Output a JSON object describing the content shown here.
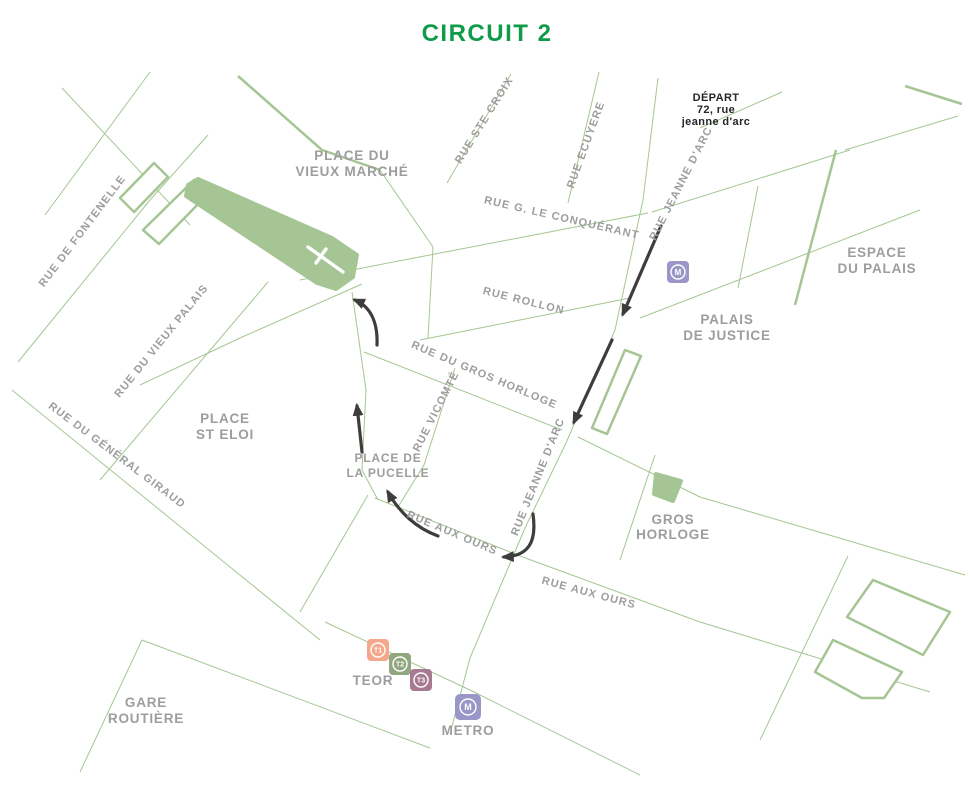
{
  "title": "CIRCUIT 2",
  "colors": {
    "bg": "#ffffff",
    "street-line": "#a5c694",
    "area-fill": "#a5c694",
    "label": "#9d9d9d",
    "title-green": "#109b4a",
    "depart": "#262626",
    "route": "#3d3d3d"
  },
  "streets": {
    "ste_croix": "RUE STE CROIX",
    "ecuyere": "RUE ECUYERE",
    "jeanne_arc_top": "RUE JEANNE D'ARC",
    "jeanne_arc_low": "RUE JEANNE D'ARC",
    "conquerant": "RUE G. LE CONQUÉRANT",
    "rollon": "RUE ROLLON",
    "gros_horloge": "RUE DU GROS HORLOGE",
    "vicomte": "RUE VICOMTÉ",
    "aux_ours_w": "RUE AUX OURS",
    "aux_ours_e": "RUE AUX OURS",
    "fontenelle": "RUE DE FONTENELLE",
    "vieux_palais": "RUE DU VIEUX PALAIS",
    "general_giraud": "RUE DU GÉNÉRAL GIRAUD"
  },
  "places": {
    "vieux_marche_1": "PLACE DU",
    "vieux_marche_2": "VIEUX MARCHÉ",
    "st_eloi_1": "PLACE",
    "st_eloi_2": "ST ELOI",
    "pucelle_1": "PLACE DE",
    "pucelle_2": "LA PUCELLE",
    "espace_palais_1": "ESPACE",
    "espace_palais_2": "DU PALAIS",
    "palais_justice_1": "PALAIS",
    "palais_justice_2": "DE JUSTICE",
    "gros_horloge_1": "GROS",
    "gros_horloge_2": "HORLOGE",
    "gare_1": "GARE",
    "gare_2": "ROUTIÈRE",
    "teor": "TEOR",
    "metro": "METRO"
  },
  "depart": {
    "line1": "DÉPART",
    "line2": "72, rue",
    "line3": "jeanne d'arc"
  },
  "transit_icons": {
    "metro_label": "M",
    "t1_label": "T1",
    "t2_label": "T2",
    "t3_label": "T3",
    "metro_color": "#9b96c8",
    "t1_color": "#f4a78a",
    "t2_color": "#92a780",
    "t3_color": "#a77a92"
  }
}
